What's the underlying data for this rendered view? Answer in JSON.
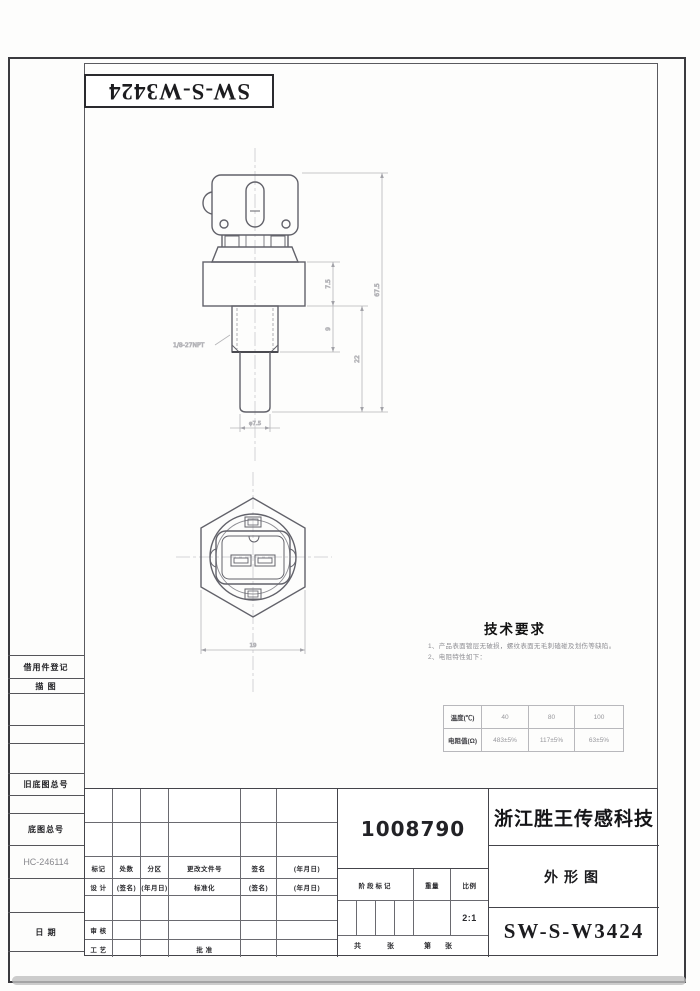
{
  "sheet": {
    "top_part_code": "SW-S-W3424",
    "margin_labels": {
      "borrow": "借用件登记",
      "trace": "描  图",
      "old_base_no": "旧底图总号",
      "base_no": "底图总号",
      "base_no_value": "HC-246114",
      "date": "日  期"
    }
  },
  "views": {
    "thread_label": "1/8-27NPT",
    "dims": {
      "overall_height": "67.5",
      "hex_height": "7.5",
      "thread_length": "9",
      "lower_length": "22",
      "tip_diameter": "φ7.5",
      "across_flats": "19"
    }
  },
  "tech_requirements": {
    "title": "技术要求",
    "items": [
      "1、产品表面镀层无破损，螺纹表面无毛刺磕碰及划伤等缺陷。",
      "2、电阻特性如下："
    ],
    "resistance_table": {
      "rows": [
        {
          "label": "温度(℃)",
          "values": [
            "40",
            "80",
            "100"
          ]
        },
        {
          "label": "电阻值(Ω)",
          "values": [
            "483±5%",
            "117±5%",
            "63±5%"
          ]
        }
      ]
    }
  },
  "title_block": {
    "part_number": "1008790",
    "company": "浙江胜王传感科技",
    "doc_type": "外形图",
    "model": "SW-S-W3424",
    "scale_value": "2:1",
    "row_change": [
      "标记",
      "处数",
      "分区",
      "更改文件号",
      "签名",
      "(年月日)"
    ],
    "row_design": [
      "设 计",
      "(签名)",
      "(年月日)",
      "标准化",
      "(签名)",
      "(年月日)"
    ],
    "label_review": "审 核",
    "label_process": "工 艺",
    "label_approve": "批 准",
    "headers": [
      "阶段标记",
      "重量",
      "比例"
    ],
    "sheet_row": [
      "共",
      "张",
      "第",
      "张"
    ]
  }
}
